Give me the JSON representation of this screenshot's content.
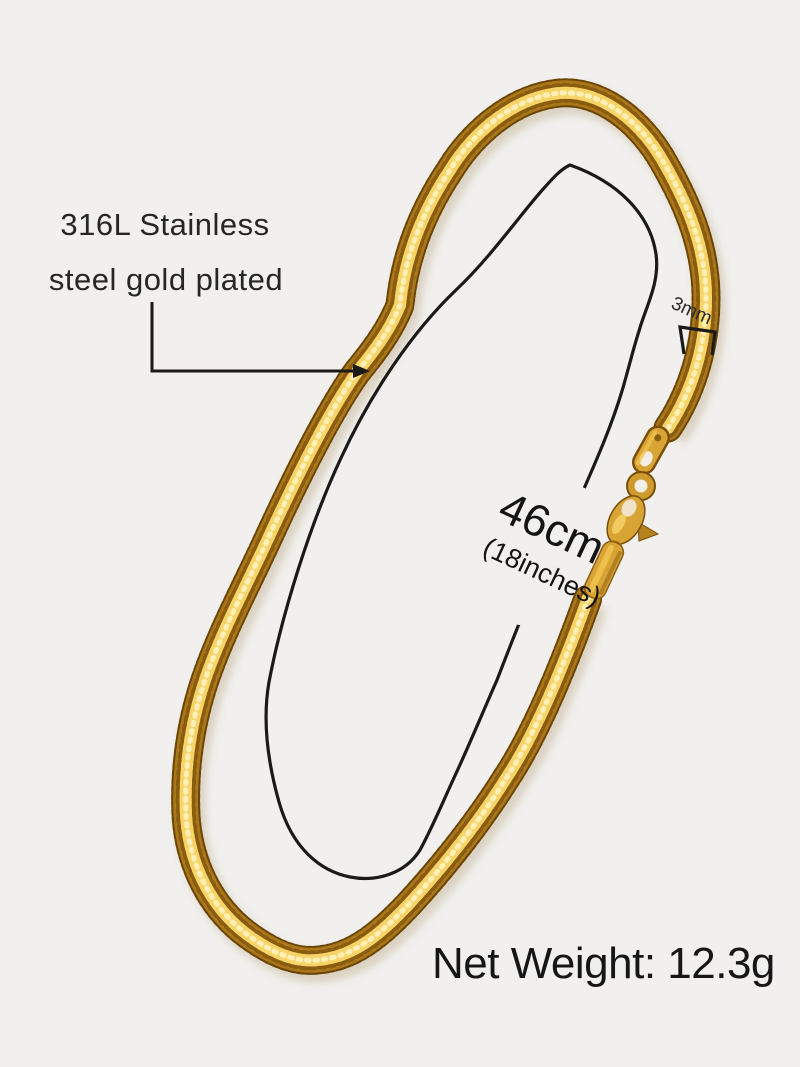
{
  "scene": {
    "description_labels": {
      "material_line1": "316L Stainless",
      "material_line2": "steel gold plated",
      "width_label": "3mm",
      "length_label": "46cm",
      "length_sublabel": "(18inches)",
      "net_weight_label": "Net Weight: 12.3g"
    },
    "colors": {
      "background": "#f1f0ee",
      "gold_base": "#cf9a2e",
      "gold_dark": "#7a4f08",
      "gold_light": "#f2c44d",
      "gold_highlight": "#fff0b8",
      "annotation_line": "#1a1a1a"
    }
  }
}
